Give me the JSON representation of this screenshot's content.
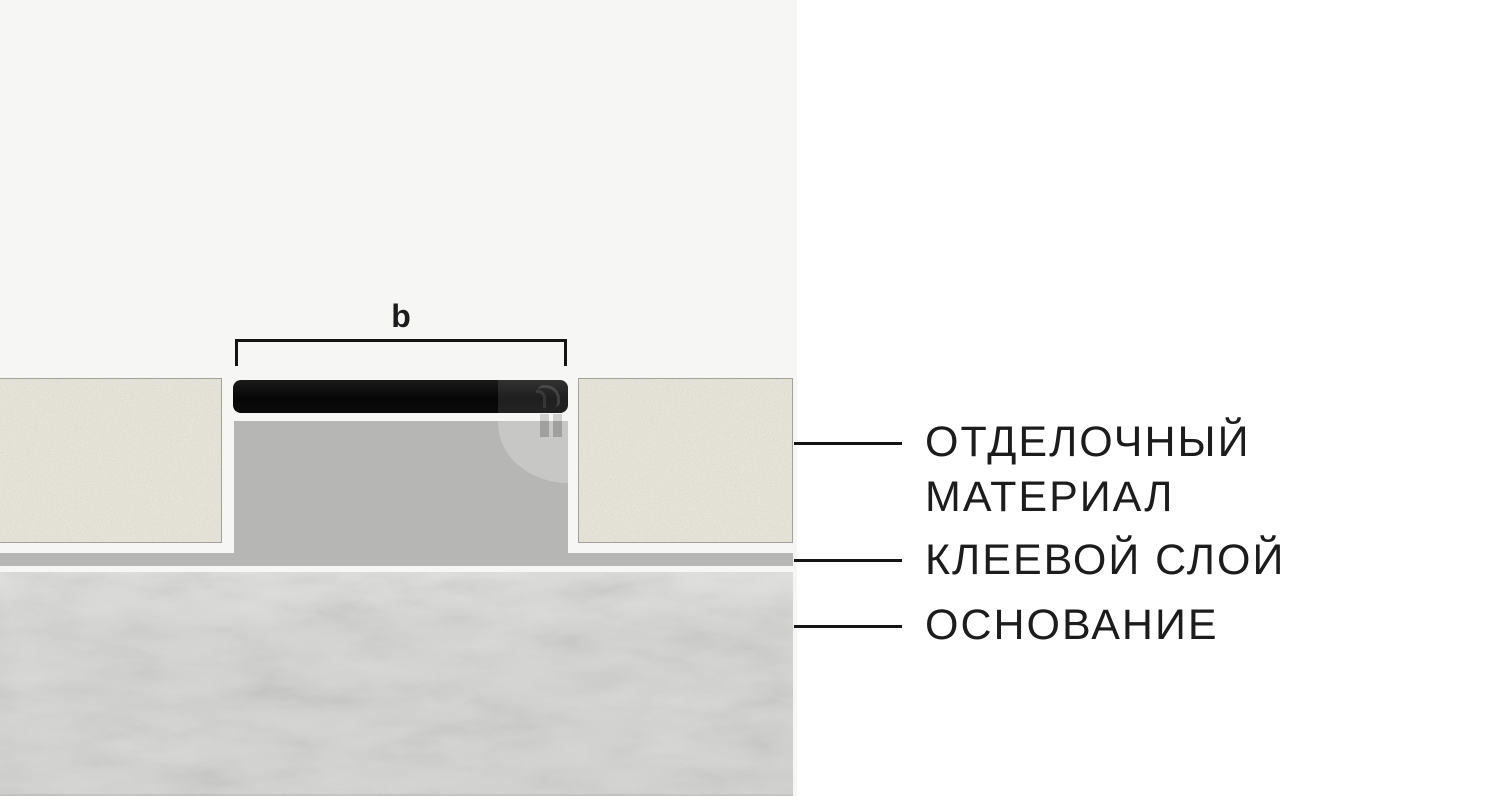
{
  "diagram": {
    "type": "flooring-profile-cross-section",
    "dimension": {
      "label": "b"
    },
    "layers": [
      {
        "id": "profile",
        "description": "black profile strip",
        "color": "#0d0d0d"
      },
      {
        "id": "finishing-material",
        "color": "#eae7db"
      },
      {
        "id": "adhesive-layer",
        "color": "#b6b6b4"
      },
      {
        "id": "base",
        "color": "#d8d8d6"
      }
    ]
  },
  "legend": {
    "items": [
      {
        "lines": [
          "ОТДЕЛОЧНЫЙ",
          "МАТЕРИАЛ"
        ]
      },
      {
        "lines": [
          "КЛЕЕВОЙ СЛОЙ"
        ]
      },
      {
        "lines": [
          "ОСНОВАНИЕ"
        ]
      }
    ]
  },
  "colors": {
    "page_bg": "#ffffff",
    "diagram_bg": "#f6f6f5",
    "finish_beige": "#eae7db",
    "finish_border": "#a3a299",
    "adhesive_gray": "#b6b6b4",
    "base_concrete": "#d8d8d6",
    "profile_black": "#0d0d0d",
    "text": "#1c1c1c",
    "line": "#141414"
  }
}
